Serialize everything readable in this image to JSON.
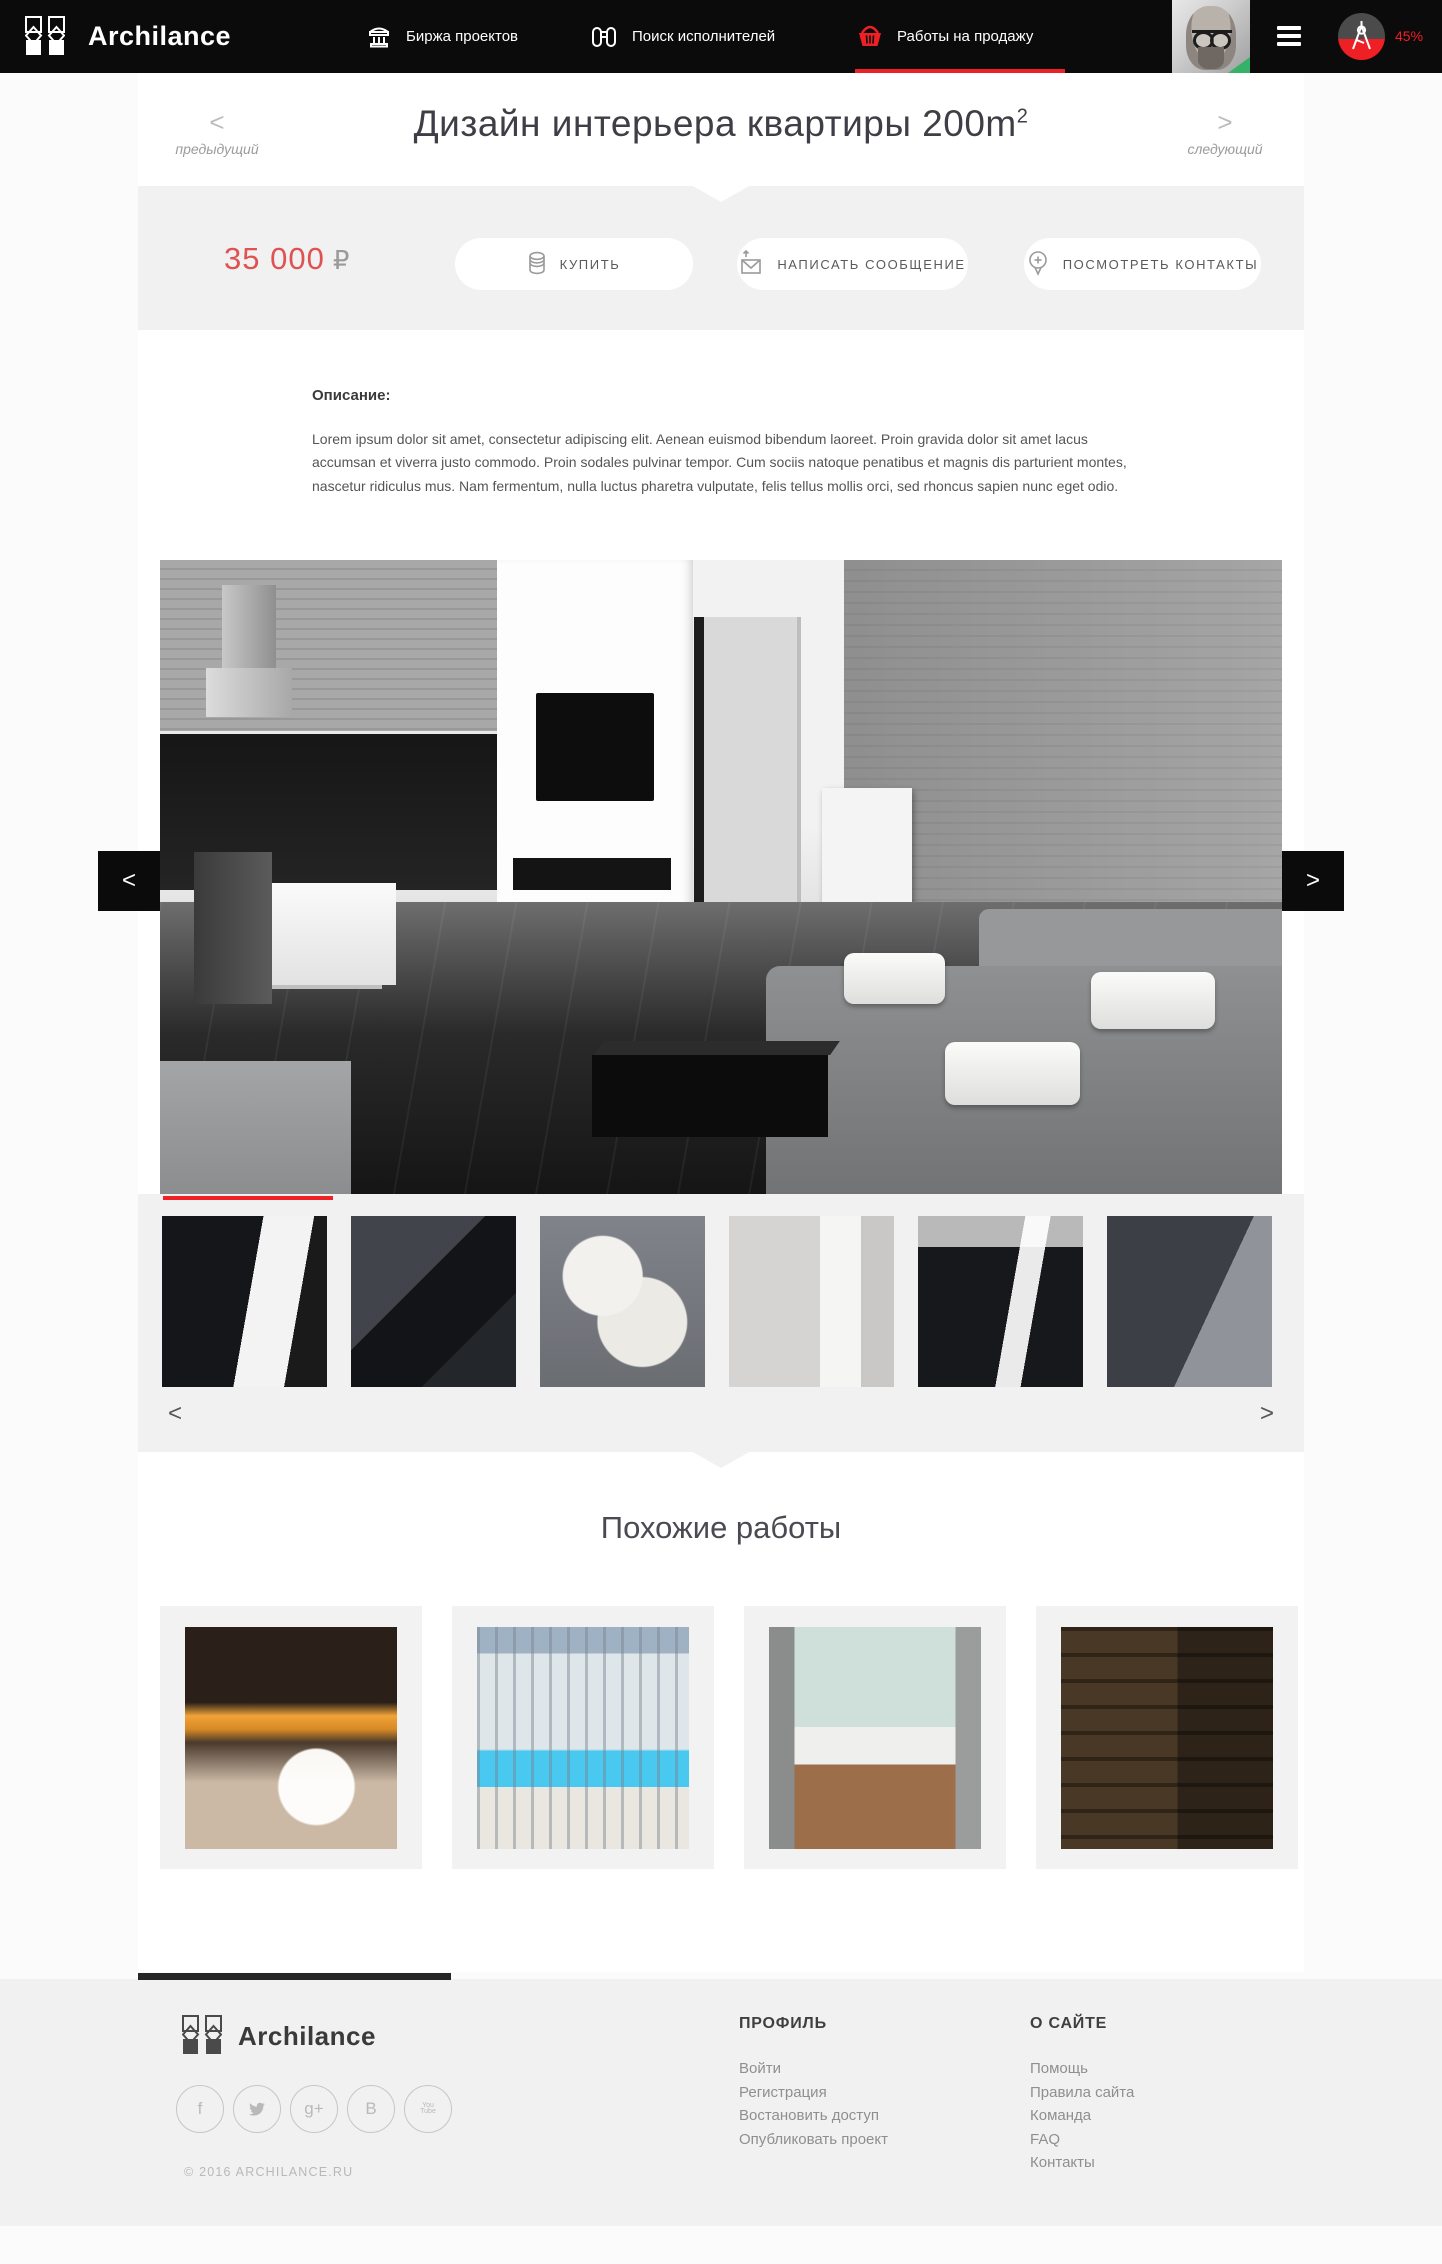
{
  "colors": {
    "accent": "#ef1f26",
    "price_red": "#e05252",
    "nav_bg": "#0b0b0b",
    "strip_gray": "#f1f1f1"
  },
  "nav": {
    "brand": "Archilance",
    "items": [
      {
        "label": "Биржа проектов",
        "icon": "bank-icon"
      },
      {
        "label": "Поиск исполнителей",
        "icon": "binoculars-icon"
      },
      {
        "label": "Работы на продажу",
        "icon": "basket-icon",
        "active": true
      }
    ],
    "progress_percent": "45%"
  },
  "pager": {
    "title": "Дизайн интерьера квартиры 200m",
    "title_sup": "2",
    "prev_arrow": "<",
    "next_arrow": ">",
    "prev_label": "предыдущий",
    "next_label": "следующий"
  },
  "purchase": {
    "price": "35 000",
    "currency": "₽",
    "buy_label": "КУПИТЬ",
    "message_label": "НАПИСАТЬ СООБЩЕНИЕ",
    "contacts_label": "ПОСМОТРЕТЬ КОНТАКТЫ"
  },
  "description": {
    "heading": "Описание:",
    "body": "Lorem ipsum dolor sit amet, consectetur adipiscing elit. Aenean euismod bibendum laoreet. Proin gravida dolor sit amet lacus accumsan et viverra justo commodo. Proin sodales pulvinar tempor. Cum sociis natoque penatibus et magnis dis parturient montes, nascetur ridiculus mus. Nam fermentum, nulla luctus pharetra vulputate, felis tellus mollis orci, sed rhoncus sapien nunc eget odio."
  },
  "gallery": {
    "main_photo_alt": "Интерьер квартиры — гостиная и кухня",
    "side_prev": "<",
    "side_next": ">",
    "thumbs_prev": "<",
    "thumbs_next": ">",
    "thumbnails": [
      "кухня — тёмные фасады",
      "чёрный стол",
      "подушки на диване",
      "бетонная стена с проёмом",
      "барные стулья",
      "диван и тёмный пол"
    ]
  },
  "similar": {
    "title": "Похожие работы",
    "cards": [
      "камин",
      "атриум торгового центра",
      "гостиная с панорамным окном",
      "библиотека"
    ]
  },
  "footer": {
    "brand": "Archilance",
    "copyright": "© 2016 ARCHILANCE.RU",
    "social": [
      {
        "name": "facebook",
        "glyph": "f"
      },
      {
        "name": "twitter",
        "glyph": ""
      },
      {
        "name": "google-plus",
        "glyph": "g+"
      },
      {
        "name": "vk",
        "glyph": "B"
      },
      {
        "name": "youtube",
        "glyph": "You Tube"
      }
    ],
    "columns": [
      {
        "title": "ПРОФИЛЬ",
        "links": [
          "Войти",
          "Регистрация",
          "Востановить доступ",
          "Опубликовать проект"
        ]
      },
      {
        "title": "О САЙТЕ",
        "links": [
          "Помощь",
          "Правила сайта",
          "Команда",
          "FAQ",
          "Контакты"
        ]
      }
    ]
  }
}
